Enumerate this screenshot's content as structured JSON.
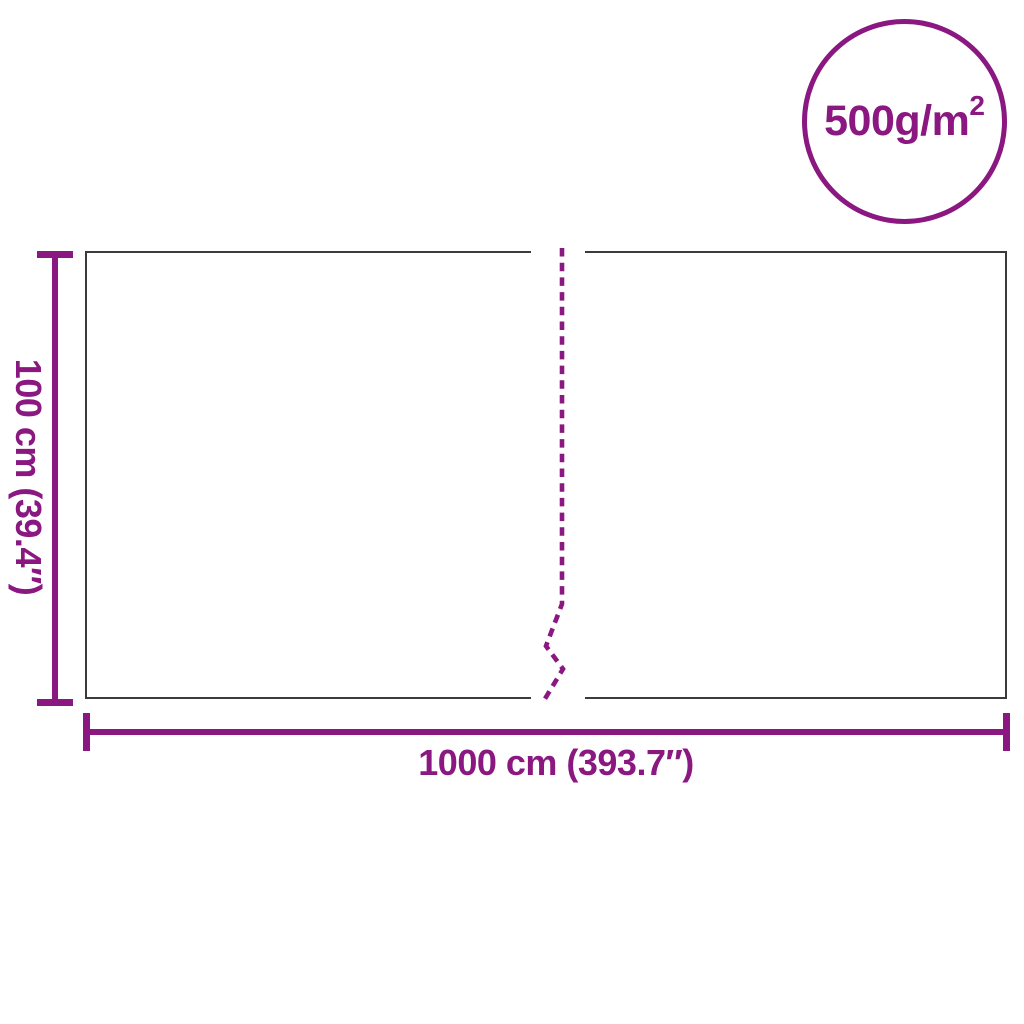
{
  "diagram": {
    "type": "product-dimension-diagram",
    "background": "#FFFFFF",
    "dimensions": {
      "height_label": "100 cm (39.4″)",
      "width_label": "1000 cm (393.7″)"
    },
    "badge": {
      "value": "500g/m",
      "superscript": "2"
    },
    "colors": {
      "accent_purple": "#8B1781",
      "outline_gray": "#3B3B3B"
    }
  }
}
